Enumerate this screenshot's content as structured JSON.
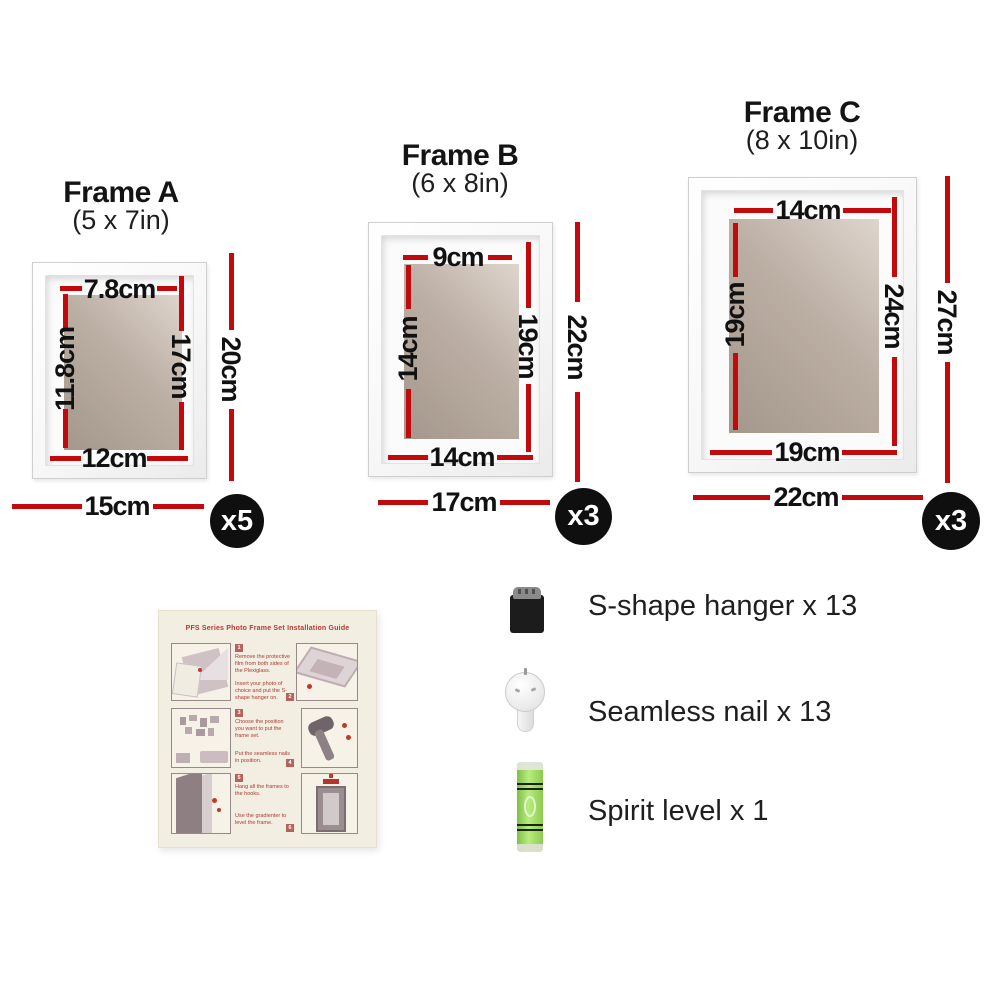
{
  "colors": {
    "dimension_red": "#c20a0c",
    "badge_bg": "#0f0f0f",
    "badge_fg": "#ffffff"
  },
  "frames": [
    {
      "title": "Frame A",
      "subtitle": "(5 x 7in)",
      "badge": "x5",
      "dims": {
        "inner_top": "7.8cm",
        "inner_left": "11.8cm",
        "inner_right": "17cm",
        "inner_bottom": "12cm",
        "outer_height": "20cm",
        "outer_width": "15cm"
      }
    },
    {
      "title": "Frame B",
      "subtitle": "(6 x 8in)",
      "badge": "x3",
      "dims": {
        "inner_top": "9cm",
        "inner_left": "14cm",
        "inner_right": "19cm",
        "inner_bottom": "14cm",
        "outer_height": "22cm",
        "outer_width": "17cm"
      }
    },
    {
      "title": "Frame C",
      "subtitle": "(8 x 10in)",
      "badge": "x3",
      "dims": {
        "inner_top": "14cm",
        "inner_left": "19cm",
        "inner_right": "24cm",
        "inner_bottom": "19cm",
        "outer_height": "27cm",
        "outer_width": "22cm"
      }
    }
  ],
  "hardware": [
    {
      "label": "S-shape hanger x 13"
    },
    {
      "label": "Seamless nail x 13"
    },
    {
      "label": "Spirit level x 1"
    }
  ],
  "guide": {
    "title": "PFS Series Photo Frame Set Installation Guide",
    "steps": [
      {
        "num": "1",
        "text": "Remove the protective film from both sides of the Plexiglass."
      },
      {
        "num": "2",
        "text": "Insert your photo of choice and put the S-shape hanger on."
      },
      {
        "num": "3",
        "text": "Choose the position you want to put the frame set."
      },
      {
        "num": "4",
        "text": "Put the seamless nails in position."
      },
      {
        "num": "5",
        "text": "Hang all the frames to the hooks."
      },
      {
        "num": "6",
        "text": "Use the gradienter to level the frame."
      }
    ]
  }
}
